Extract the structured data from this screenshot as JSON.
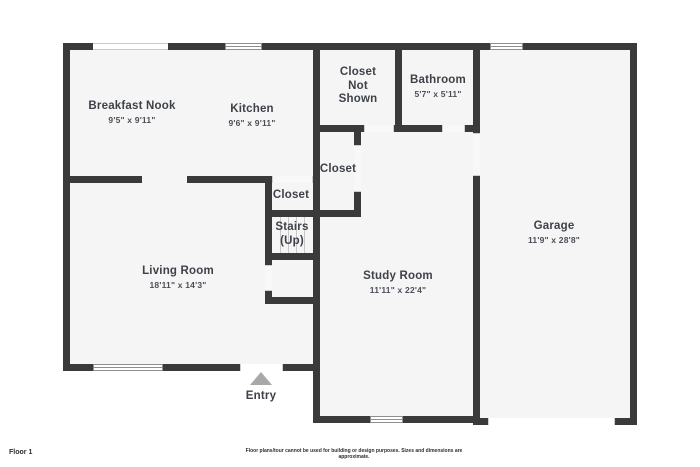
{
  "canvas": {
    "width": 700,
    "height": 467
  },
  "colors": {
    "wall": "#3a3a3a",
    "floor": "#f5f5f6",
    "background": "#ffffff",
    "window_frame": "#8f8f8f",
    "entry_triangle": "#a8a8a8",
    "room_label": "#3e4248",
    "room_dims": "#4b4f55"
  },
  "rooms": {
    "breakfast_nook": {
      "name": "Breakfast Nook",
      "dims": "9'5\" x 9'11\""
    },
    "kitchen": {
      "name": "Kitchen",
      "dims": "9'6\" x 9'11\""
    },
    "closet_not_shown": {
      "name": "Closet Not Shown"
    },
    "bathroom": {
      "name": "Bathroom",
      "dims": "5'7\" x 5'11\""
    },
    "closet_upper": {
      "name": "Closet"
    },
    "closet_lower": {
      "name": "Closet"
    },
    "stairs": {
      "name": "Stairs (Up)"
    },
    "living_room": {
      "name": "Living Room",
      "dims": "18'11\" x 14'3\""
    },
    "study_room": {
      "name": "Study Room",
      "dims": "11'11\" x 22'4\""
    },
    "garage": {
      "name": "Garage",
      "dims": "11'9\" x 28'8\""
    },
    "entry": {
      "name": "Entry"
    }
  },
  "footer": {
    "floor_label": "Floor 1",
    "disclaimer": "Floor plans/tour cannot be used for building or design purposes. Sizes and dimensions are approximate."
  }
}
